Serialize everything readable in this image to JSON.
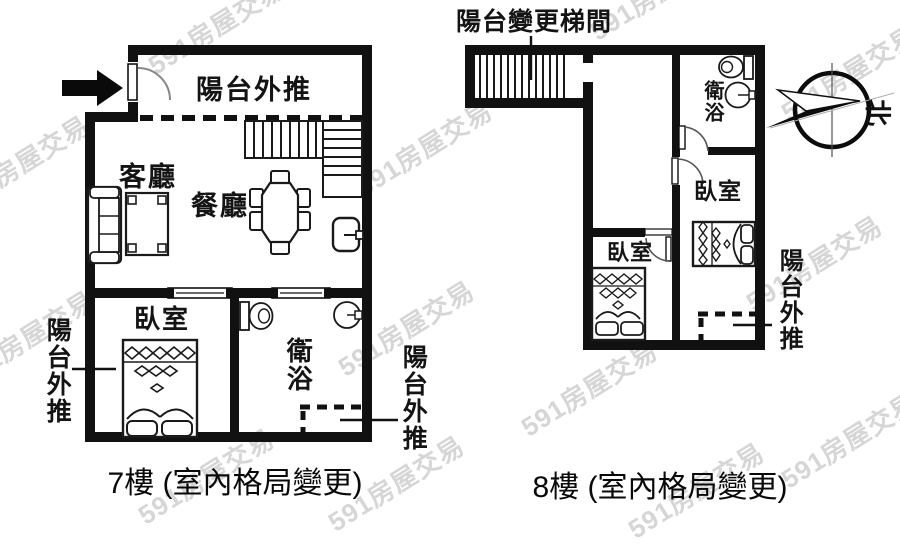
{
  "watermark": {
    "text": "591房屋交易"
  },
  "compass": {
    "north_label": "北"
  },
  "left_plan": {
    "caption": "7樓 (室內格局變更)",
    "balcony_top_label": "陽台外推",
    "living_room_label": "客廳",
    "dining_room_label": "餐廳",
    "bedroom_label": "臥室",
    "bathroom_label": "衛浴",
    "balcony_left_label": "陽台外推",
    "balcony_right_label": "陽台外推"
  },
  "right_plan": {
    "caption": "8樓 (室內格局變更)",
    "stairwell_label": "陽台變更梯間",
    "bathroom_label": "衛浴",
    "bedroom_right_label": "臥室",
    "bedroom_left_label": "臥室",
    "balcony_right_label": "陽台外推"
  },
  "colors": {
    "ink": "#111111",
    "watermark": "#c9c9c9"
  }
}
